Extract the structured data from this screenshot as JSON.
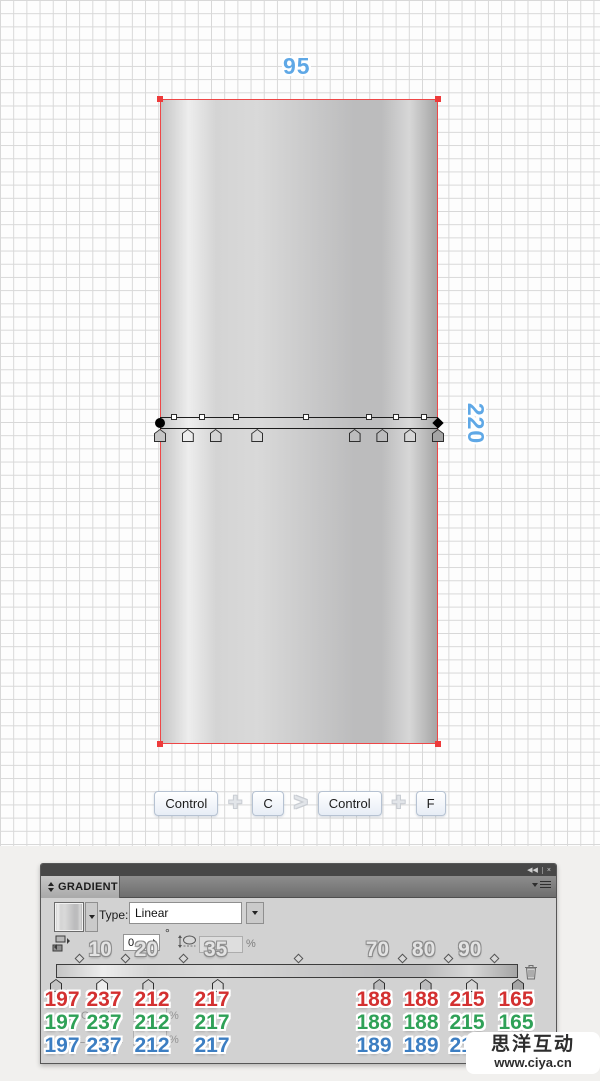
{
  "canvas": {
    "width_label": "95",
    "height_label": "220",
    "shortcuts": {
      "keys": [
        "Control",
        "C",
        "Control",
        "F"
      ],
      "separators": [
        "+",
        ">",
        "+"
      ]
    }
  },
  "gradient": {
    "type": "linear",
    "stops": [
      {
        "location": 0,
        "r": 197,
        "g": 197,
        "b": 197,
        "label": ""
      },
      {
        "location": 10,
        "r": 237,
        "g": 237,
        "b": 237,
        "label": "10"
      },
      {
        "location": 20,
        "r": 212,
        "g": 212,
        "b": 212,
        "label": "20"
      },
      {
        "location": 35,
        "r": 217,
        "g": 217,
        "b": 217,
        "label": "35"
      },
      {
        "location": 70,
        "r": 188,
        "g": 188,
        "b": 189,
        "label": "70"
      },
      {
        "location": 80,
        "r": 188,
        "g": 188,
        "b": 189,
        "label": "80"
      },
      {
        "location": 90,
        "r": 215,
        "g": 215,
        "b": 215,
        "label": "90"
      },
      {
        "location": 100,
        "r": 165,
        "g": 165,
        "b": 165,
        "label": ""
      }
    ],
    "midpoints": [
      5,
      15,
      27.5,
      52.5,
      75,
      85,
      95
    ]
  },
  "panel": {
    "title": "GRADIENT",
    "type_label": "Type:",
    "type_value": "Linear",
    "angle_value": "0",
    "degree_symbol": "°",
    "percent_symbol": "%",
    "opacity_label": "Opacity:",
    "location_label": "Location:",
    "icons": {
      "collapse_glyph": "◀◀",
      "close_glyph": "×"
    },
    "rgb_rows": {
      "red": [
        "197",
        "237",
        "212",
        "217",
        "188",
        "188",
        "215",
        "165"
      ],
      "green": [
        "197",
        "237",
        "212",
        "217",
        "188",
        "188",
        "215",
        "165"
      ],
      "blue": [
        "197",
        "237",
        "212",
        "217",
        "189",
        "189",
        "215",
        "165"
      ]
    },
    "colors": {
      "red_text": "#d33030",
      "green_text": "#2fa157",
      "blue_text": "#3c7ec2",
      "dimension_text": "#5fa8e6"
    }
  },
  "watermark": {
    "line1": "思洋互动",
    "line2": "www.ciya.cn"
  }
}
